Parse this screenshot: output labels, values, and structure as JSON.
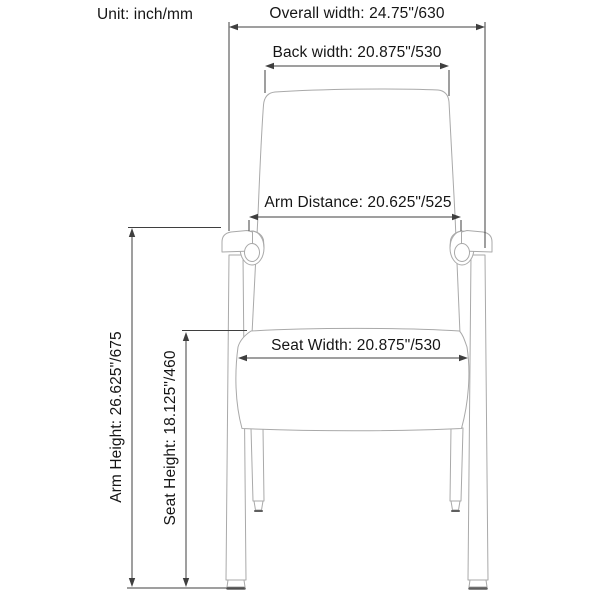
{
  "unit_label": "Unit: inch/mm",
  "diagram": {
    "subject": "guest-chair-front-view-dimension-drawing",
    "dimensions": {
      "overall_width": {
        "name": "Overall width",
        "label": "Overall width: 24.75\"/630",
        "inches": "24.75\"",
        "mm": "630"
      },
      "back_width": {
        "name": "Back width",
        "label": "Back width: 20.875\"/530",
        "inches": "20.875\"",
        "mm": "530"
      },
      "arm_distance": {
        "name": "Arm Distance",
        "label": "Arm Distance: 20.625\"/525",
        "inches": "20.625\"",
        "mm": "525"
      },
      "seat_width": {
        "name": "Seat Width",
        "label": "Seat Width: 20.875\"/530",
        "inches": "20.875\"",
        "mm": "530"
      },
      "arm_height": {
        "name": "Arm Height",
        "label": "Arm Height: 26.625\"/675",
        "inches": "26.625\"",
        "mm": "675"
      },
      "seat_height": {
        "name": "Seat Height",
        "label": "Seat Height: 18.125\"/460",
        "inches": "18.125\"",
        "mm": "460"
      }
    }
  },
  "colors": {
    "background": "#ffffff",
    "chair_line": "#a9a9a9",
    "dimension_line": "#3f3f3f",
    "text": "#151515",
    "foot_dark": "#5f5f5f"
  }
}
